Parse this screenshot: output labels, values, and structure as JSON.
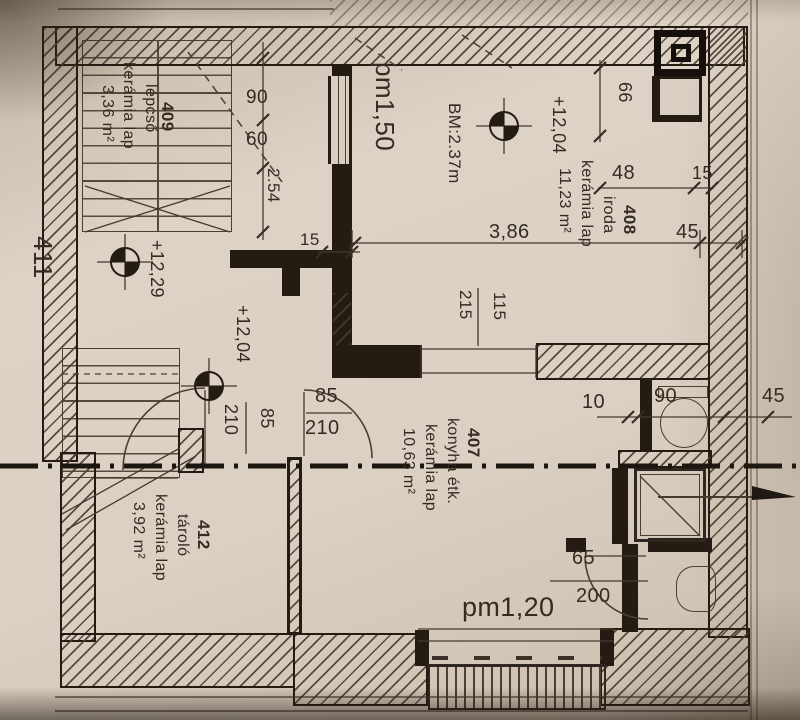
{
  "drawing": {
    "rooms": {
      "stairwell": {
        "number": "409",
        "name": "lépcső",
        "finish": "kerámia lap",
        "area": "3,36 m²"
      },
      "office": {
        "number": "408",
        "name": "iroda",
        "finish": "kerámia lap",
        "area": "11,23 m²"
      },
      "kitchen_dining": {
        "number": "407",
        "name": "konyha étk.",
        "finish": "kerámia lap",
        "area": "10,63 m²"
      },
      "storage": {
        "number": "412",
        "name": "tároló",
        "finish": "kerámia lap",
        "area": "3,92 m²"
      },
      "adjacent_number": "411"
    },
    "levels": {
      "stair_landing": "+12,29",
      "office": "+12,04",
      "hall": "+12,04"
    },
    "heights": {
      "office_clear_height": "BM:2.37m",
      "parapet_upper": "pm1,50",
      "parapet_lower": "pm1,20"
    },
    "dims": {
      "stair_run_90": "90",
      "stair_run_60": "60",
      "stair_total": "2.54",
      "wall_15": "15",
      "office_width": "3,86",
      "office_wall_45": "45",
      "top_48": "48",
      "top_15": "15",
      "chimney_66": "66",
      "opening_width": "115",
      "opening_height": "215",
      "hall_door_width": "85",
      "hall_door_height": "210",
      "storage_door_width": "85",
      "storage_door_height": "210",
      "wc_wall_10": "10",
      "wc_niche_90": "90",
      "wc_wall_45": "45",
      "bath_door_width": "65",
      "bath_door_height": "200"
    }
  },
  "colors": {
    "paper": "#d8cdc1",
    "ink": "#342b21",
    "wall": "#241c13"
  }
}
